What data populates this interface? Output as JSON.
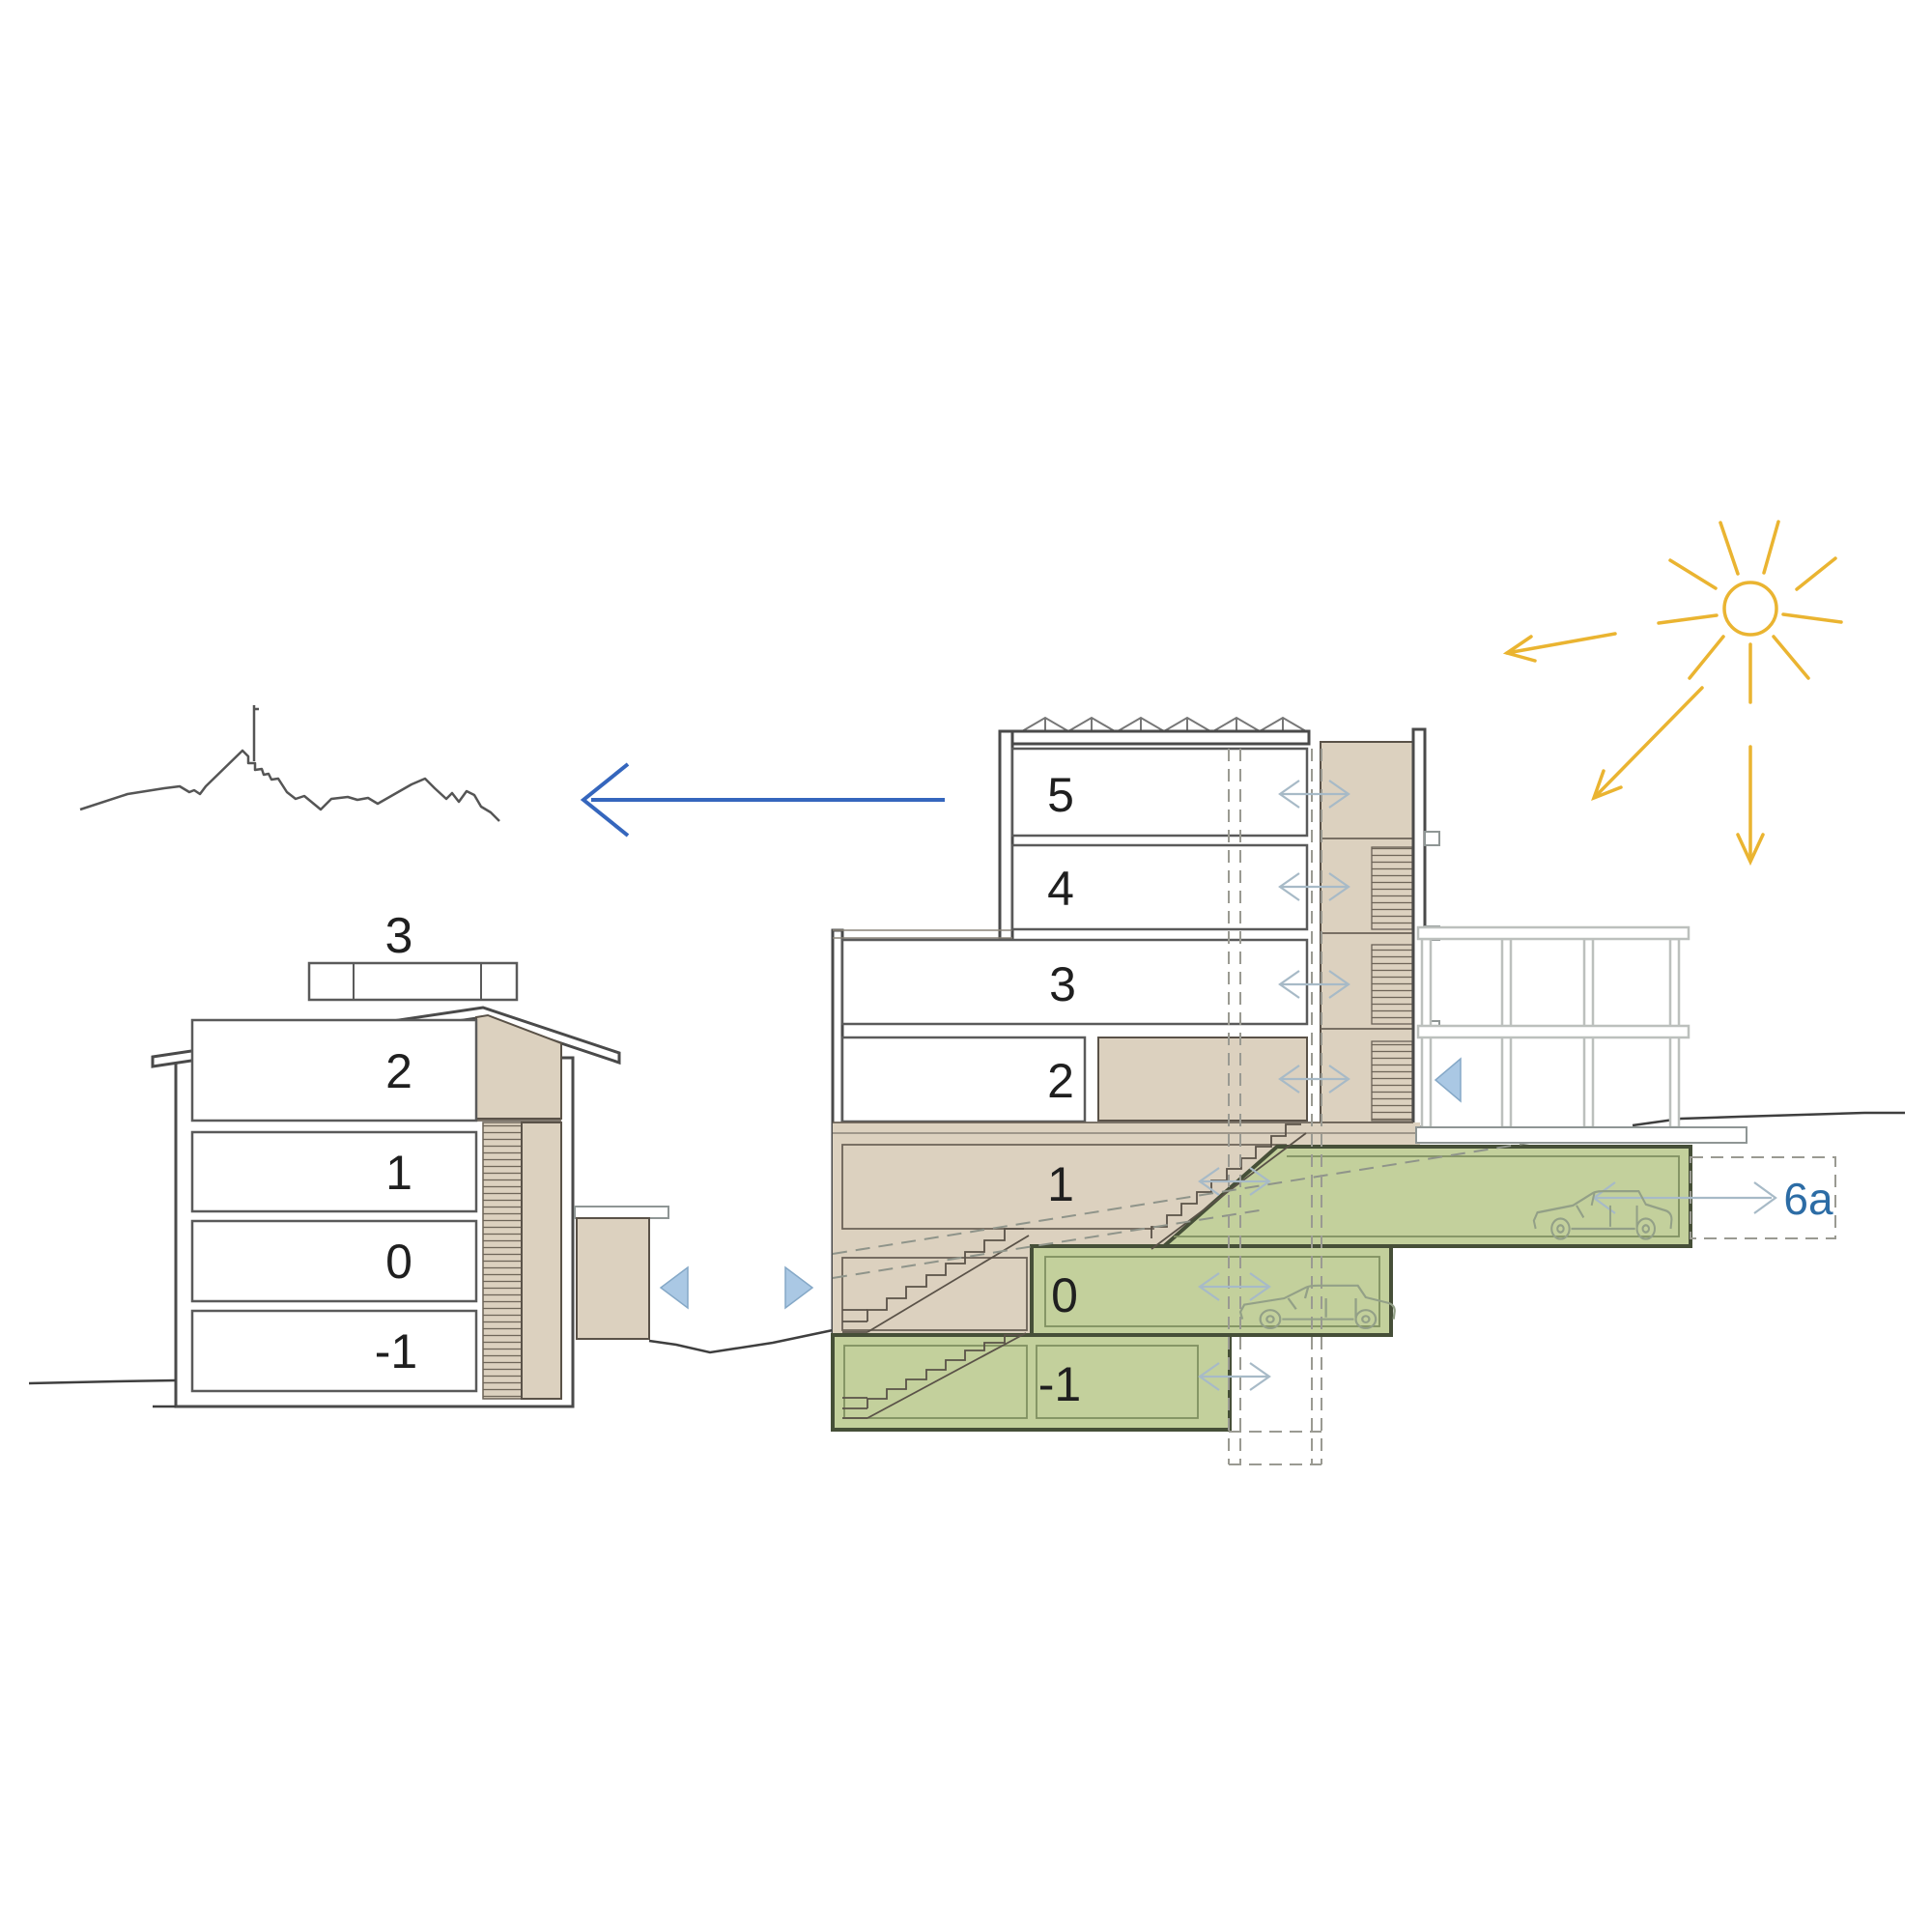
{
  "diagram": {
    "type": "architectural-section-diagram",
    "left_building": {
      "roof_label": "3",
      "floor_labels": [
        "2",
        "1",
        "0",
        "-1"
      ]
    },
    "right_building": {
      "floor_labels": [
        "5",
        "4",
        "3",
        "2",
        "1",
        "0",
        "-1"
      ]
    },
    "annotations": {
      "exit_label": "6a"
    },
    "colors": {
      "tan_fill": "#dcd1bf",
      "tan_border": "#5a5248",
      "green_fill": "#c3d09c",
      "green_border": "#464f38",
      "sun_yellow": "#eab431",
      "accent_blue_arrow": "#3566bd",
      "label_blue": "#2c6ca5",
      "triangle_blue": "#aac8e4",
      "thin_arrow_gray": "#a7bac7",
      "dash_gray": "#9a9a92",
      "outline_dark": "#4a4a4a"
    }
  }
}
